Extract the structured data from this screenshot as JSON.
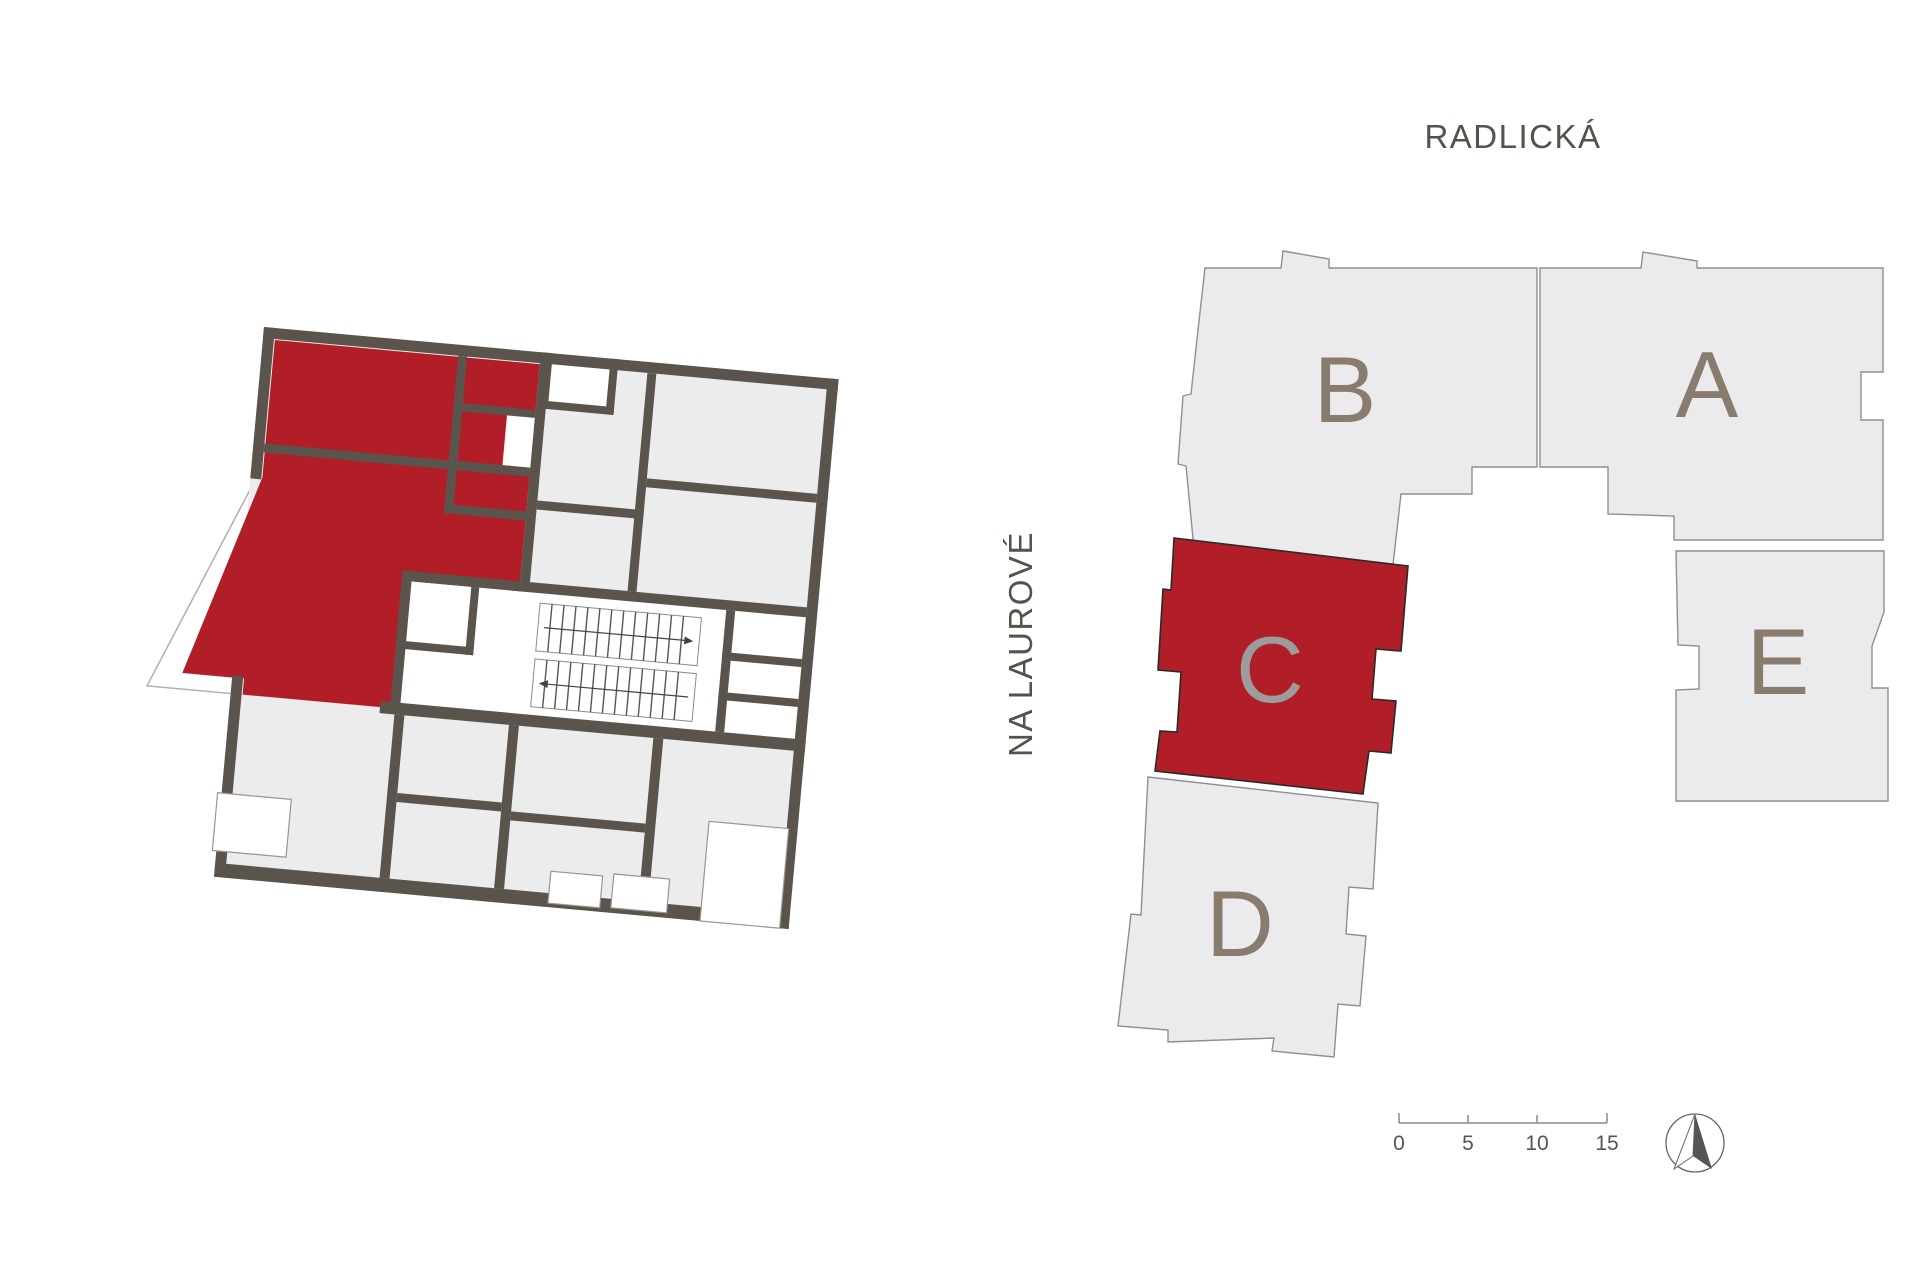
{
  "page": {
    "background": "#ffffff",
    "type": "apartment-locator-plan"
  },
  "streets": {
    "top": "RADLICKÁ",
    "left": "NA LAUROVÉ"
  },
  "site_plan": {
    "buildings": [
      {
        "id": "building-b",
        "label": "B",
        "highlighted": false
      },
      {
        "id": "building-a",
        "label": "A",
        "highlighted": false
      },
      {
        "id": "building-c",
        "label": "C",
        "highlighted": true
      },
      {
        "id": "building-e",
        "label": "E",
        "highlighted": false
      },
      {
        "id": "building-d",
        "label": "D",
        "highlighted": false
      }
    ],
    "building_fill": "#ebebed",
    "building_stroke": "#8f8f8f",
    "highlight_fill": "#b21e28",
    "letter_color": "#897c6e",
    "highlight_letter_color": "#9c9c9c"
  },
  "floor_plan": {
    "highlighted_unit_color": "#b21e28",
    "wall_color": "#5b544c",
    "room_fill": "#ececec",
    "highlighted_building": "C"
  },
  "scale_bar": {
    "ticks": [
      "0",
      "5",
      "10",
      "15"
    ]
  },
  "icons": {
    "north_arrow": "compass-north-arrow"
  }
}
